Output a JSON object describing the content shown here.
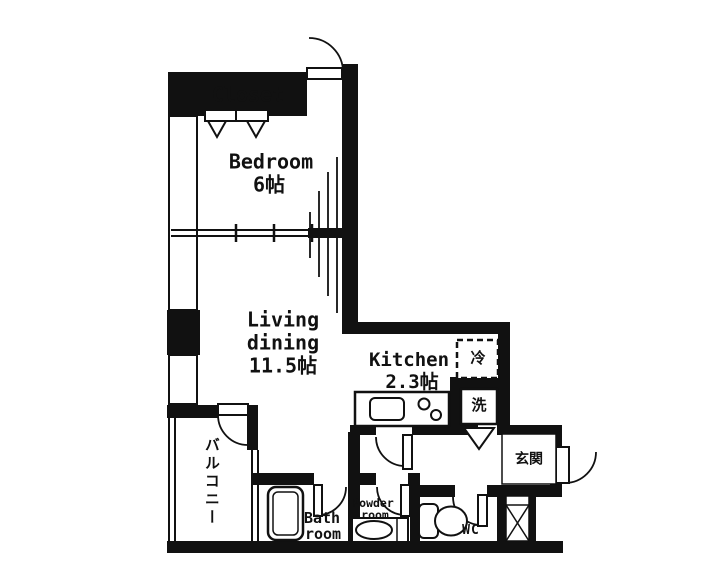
{
  "floorplan": {
    "rooms": {
      "closet": {
        "label": "Closet"
      },
      "bedroom": {
        "label": "Bedroom",
        "size": "6帖"
      },
      "living": {
        "label_line1": "Living",
        "label_line2": "dining",
        "size": "11.5帖"
      },
      "kitchen": {
        "label": "Kitchen",
        "size": "2.3帖"
      },
      "balcony": {
        "label": "バルコニー"
      },
      "bath": {
        "label_line1": "Bath",
        "label_line2": "room"
      },
      "powder": {
        "label_line1": "Powder",
        "label_line2": "room"
      },
      "wc": {
        "label": "WC"
      },
      "entrance": {
        "label": "玄関"
      }
    },
    "fixtures": {
      "refrigerator": {
        "label": "冷"
      },
      "washer": {
        "label": "洗"
      }
    },
    "colors": {
      "wall": "#111111",
      "background": "#ffffff"
    }
  }
}
